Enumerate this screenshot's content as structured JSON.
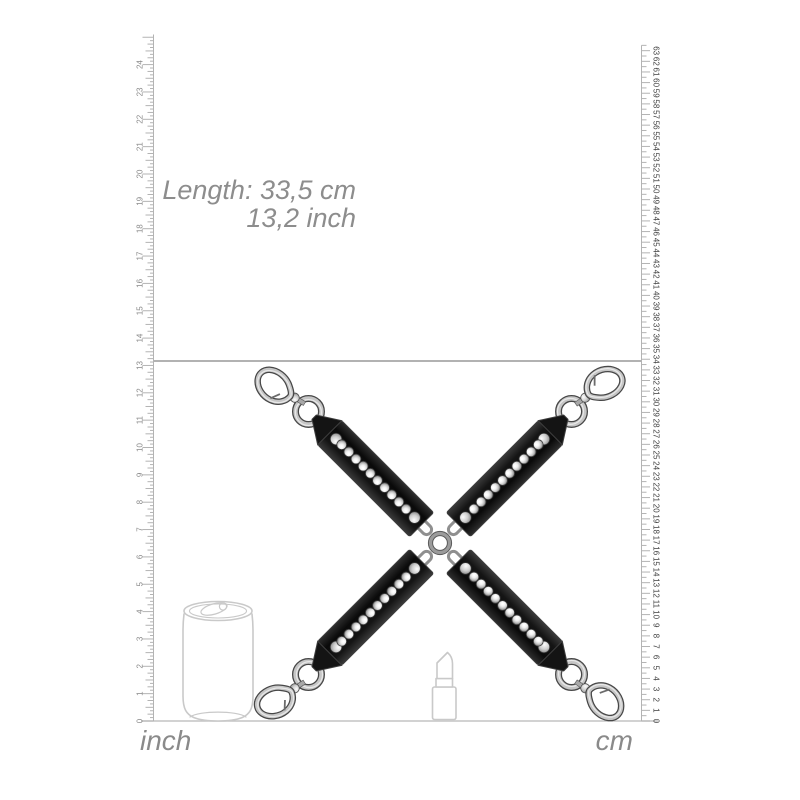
{
  "annotation": {
    "line1": "Length: 33,5 cm",
    "line2": "13,2 inch"
  },
  "measurement": {
    "length_cm": "33,5",
    "length_inch": "13,2"
  },
  "rulers": {
    "inch": {
      "unit_label": "inch",
      "min": 0,
      "max": 25.1,
      "labeled_min": 0,
      "labeled_max": 24,
      "subdivisions_per_unit": 8,
      "marked_value": 13.2,
      "side": "left"
    },
    "cm": {
      "unit_label": "cm",
      "min": 0,
      "max": 63.5,
      "labeled_min": 0,
      "labeled_max": 63,
      "subdivisions_per_unit": 2,
      "marked_value": 33.5,
      "side": "right"
    }
  },
  "product": {
    "name": "four-way hogtie cross with rhinestone straps and swivel snap hooks",
    "arms": 4,
    "rhinestones_per_strap": 10,
    "rivets_per_strap": 2,
    "strap_color": "#141414",
    "strap_edge_color": "#3d3d3d",
    "metal_dark": "#474747",
    "metal_mid": "#c6c6c6",
    "metal_highlight": "#efefef",
    "center_ring_color": "#9b9b9b"
  },
  "reference_objects": [
    {
      "name": "soda-can"
    },
    {
      "name": "lipstick"
    }
  ],
  "colors": {
    "background": "#ffffff",
    "annotation_text": "#8d8d8d",
    "ruler_tick": "#b3b3b3",
    "inch_number_color": "#8a8a8a",
    "cm_number_color": "#404040",
    "unit_label_color": "#8a8a8a",
    "length_line": "#999999",
    "ground_line": "#c4c4c4",
    "outline_drawing": "#c9c9c9"
  }
}
